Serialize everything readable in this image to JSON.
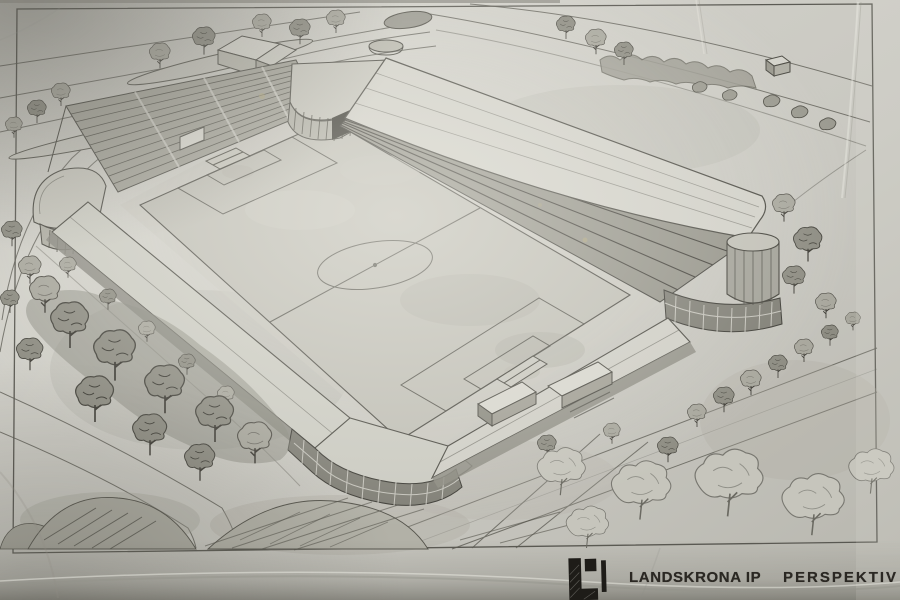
{
  "caption": {
    "club_name": "LANDSKRONA IP",
    "drawing_type": "PERSPEKTIV",
    "logo": "landskrona-ip-logo"
  },
  "colors": {
    "paper": "#cdccc5",
    "paper_highlight": "#f0efe7",
    "paper_shadow": "#8e8d85",
    "pencil": "#4c4b44",
    "pencil_dark": "#3b3a33",
    "print_ink": "#26231e"
  },
  "scene": {
    "description": "Hand-drawn aerial perspective sketch of the Landskrona IP football stadium",
    "elements": [
      "football-pitch",
      "center-circle",
      "penalty-areas",
      "goals",
      "main-stand-roof",
      "open-terraces",
      "corner-tower",
      "glazed-corner-buildings",
      "west-pavilion",
      "surrounding-trees",
      "access-roads",
      "grass-mounds",
      "drawing-border"
    ]
  }
}
